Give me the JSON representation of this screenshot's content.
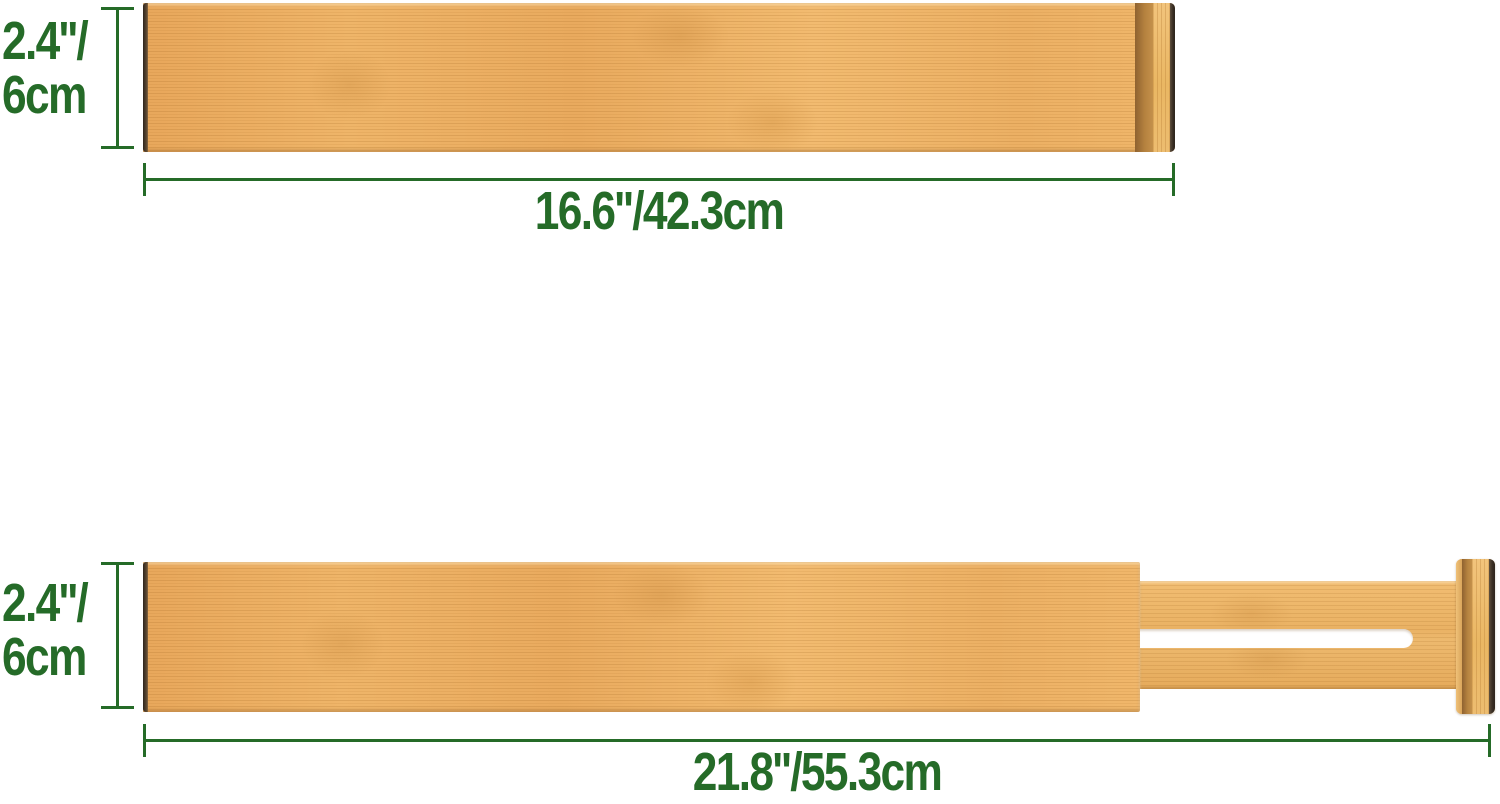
{
  "colors": {
    "accent": "#256b28",
    "background": "#ffffff",
    "bambooEdgeDark": "#3a2f25",
    "bambooCapDark": "#a9763a"
  },
  "dividers": {
    "top": {
      "height_label_line1": "2.4''/",
      "height_label_line2": "6cm",
      "length_label": "16.6''/42.3cm"
    },
    "bottom": {
      "height_label_line1": "2.4''/",
      "height_label_line2": "6cm",
      "length_label": "21.8''/55.3cm"
    }
  }
}
